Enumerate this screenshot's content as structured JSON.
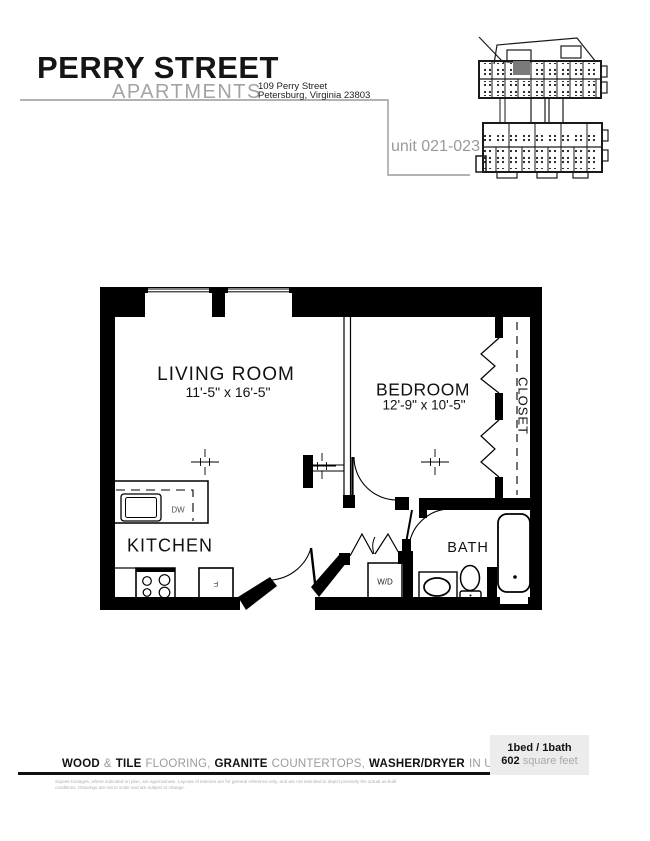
{
  "header": {
    "title": "PERRY STREET",
    "subtitle": "APARTMENTS",
    "address_line1": "109 Perry Street",
    "address_line2": "Petersburg, Virginia 23803",
    "unit_label": "unit 021-023"
  },
  "plan": {
    "living_room": {
      "name": "LIVING ROOM",
      "dims": "11'-5\" x 16'-5\""
    },
    "bedroom": {
      "name": "BEDROOM",
      "dims": "12'-9\" x 10'-5\""
    },
    "kitchen": {
      "name": "KITCHEN"
    },
    "bath": {
      "name": "BATH"
    },
    "closet": {
      "name": "CLOSET"
    },
    "appliances": {
      "dishwasher": "DW",
      "refrigerator": "F",
      "washer_dryer": "W/D"
    }
  },
  "footer": {
    "features": {
      "wood": "WOOD",
      "amp": "&",
      "tile": "TILE",
      "flooring": "FLOORING,",
      "granite": "GRANITE",
      "countertops": "COUNTERTOPS,",
      "washer_dryer": "WASHER/DRYER",
      "in_unit": "IN UNIT"
    },
    "disclaimer_line1": "Square footages, where indicated on plan, are approximate. Layouts of interiors are for general reference only, and are not intended to depict precisely the actual as-built",
    "disclaimer_line2": "conditions. Drawings are not to scale and are subject to change.",
    "unit_info": {
      "beds_baths": "1bed / 1bath",
      "sqft_value": "602",
      "sqft_label": "square feet"
    }
  },
  "colors": {
    "wall": "#000000",
    "accent_gray": "#9a9a9a",
    "highlight_unit": "#7a7a7a",
    "info_box_bg": "#ececec"
  }
}
